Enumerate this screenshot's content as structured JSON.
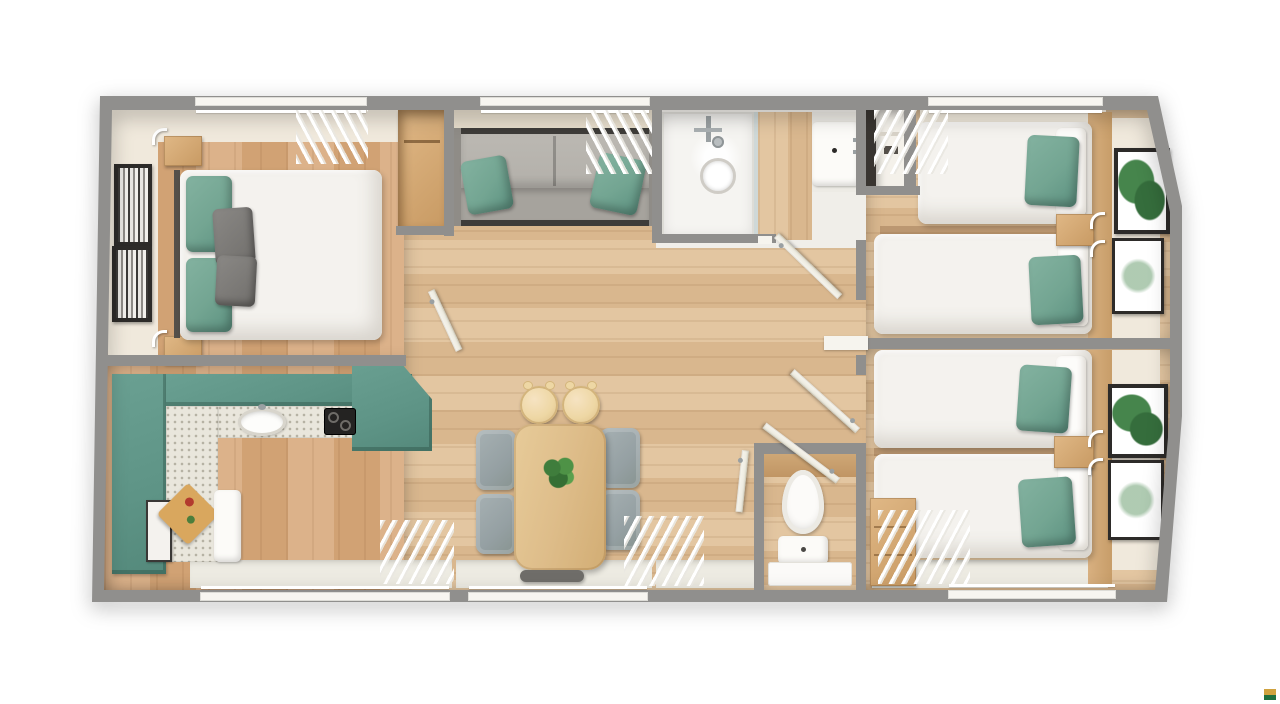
{
  "meta": {
    "title": "Holiday lodge floor plan",
    "view": "top-down 3D render",
    "style": "photoreal dollhouse floor plan on white background"
  },
  "palette": {
    "page-bg": "#ffffff",
    "wall": "#908f8d",
    "wall-face": "#f0e9dc",
    "wall-face-dark": "#e6ddcc",
    "off-white": "#edebe2",
    "wood-a": "#dcb28a",
    "wood-a-dark": "#d1a274",
    "wood-b": "#e3c6a1",
    "wood-b-dark": "#d9b78e",
    "wood-trim": "#d2a977",
    "teal": "#5e9486",
    "teal-dark": "#466f64",
    "counter": "#e9e6dc",
    "counter-dot": "#b5b1a3",
    "sofa-back": "#b3b0aa",
    "sofa-seat": "#a6a39d",
    "sofa-rail": "#3e3c39",
    "cushion-green": "#73a592",
    "duvet": "#f4f2ee",
    "duvet-shadow": "#d8d4cd",
    "pillow-gray": "#716f6c",
    "table-wood": "#debd8a",
    "stool-wood": "#eed7a4",
    "chair-gray": "#95a0a3",
    "bench-gray": "#6f6d69",
    "frame-dark": "#2d2b29",
    "leaf-green": "#46854c",
    "appliance-dark": "#242322",
    "door-white": "#efede3",
    "glass": "#c9d4d4",
    "board-wood": "#d9a75e",
    "logo-gold": "#cfa23f",
    "logo-green": "#1e6f3e"
  },
  "rooms": [
    {
      "id": "master-bedroom",
      "label": "Master bedroom",
      "furniture": [
        "double bed",
        "2 green pillows",
        "2 grey pillows",
        "2 bedside tables with reading lamps",
        "2 framed prints",
        "open wardrobe",
        "window with curtains"
      ]
    },
    {
      "id": "kitchen",
      "label": "Kitchen",
      "furniture": [
        "L-shaped teal units",
        "speckled worktop",
        "round sink",
        "black hob",
        "oven",
        "fridge",
        "chopping board",
        "window with curtains"
      ]
    },
    {
      "id": "lounge",
      "label": "Lounge",
      "furniture": [
        "grey sofa",
        "2 green scatter cushions",
        "window with curtains"
      ]
    },
    {
      "id": "dining-area",
      "label": "Dining area",
      "furniture": [
        "wooden dining table",
        "potted plant",
        "4 grey chairs",
        "2 wooden stools",
        "bench",
        "window with curtains"
      ]
    },
    {
      "id": "shower-room",
      "label": "Shower room",
      "furniture": [
        "shower enclosure",
        "glass screen",
        "washbasin unit"
      ]
    },
    {
      "id": "storage-cupboard",
      "label": "Storage cupboard",
      "furniture": [
        "shelf"
      ]
    },
    {
      "id": "hallway",
      "label": "Hallway",
      "furniture": [
        "4 open doors"
      ]
    },
    {
      "id": "wc",
      "label": "WC",
      "furniture": [
        "toilet",
        "mat"
      ]
    },
    {
      "id": "twin-bedroom-1",
      "label": "Twin bedroom 1",
      "furniture": [
        "2 single beds",
        "green pillows",
        "bedside shelf with reading lamps",
        "2 botanical prints",
        "window with curtains"
      ]
    },
    {
      "id": "twin-bedroom-2",
      "label": "Twin bedroom 2",
      "furniture": [
        "2 single beds",
        "green pillows",
        "bedside shelf with reading lamps",
        "2 botanical prints",
        "chest of drawers",
        "window with curtains"
      ]
    }
  ],
  "branding": {
    "corner_logo": {
      "shape": "small two-tone square",
      "top_color_key": "logo-gold",
      "bottom_color_key": "logo-green"
    }
  }
}
